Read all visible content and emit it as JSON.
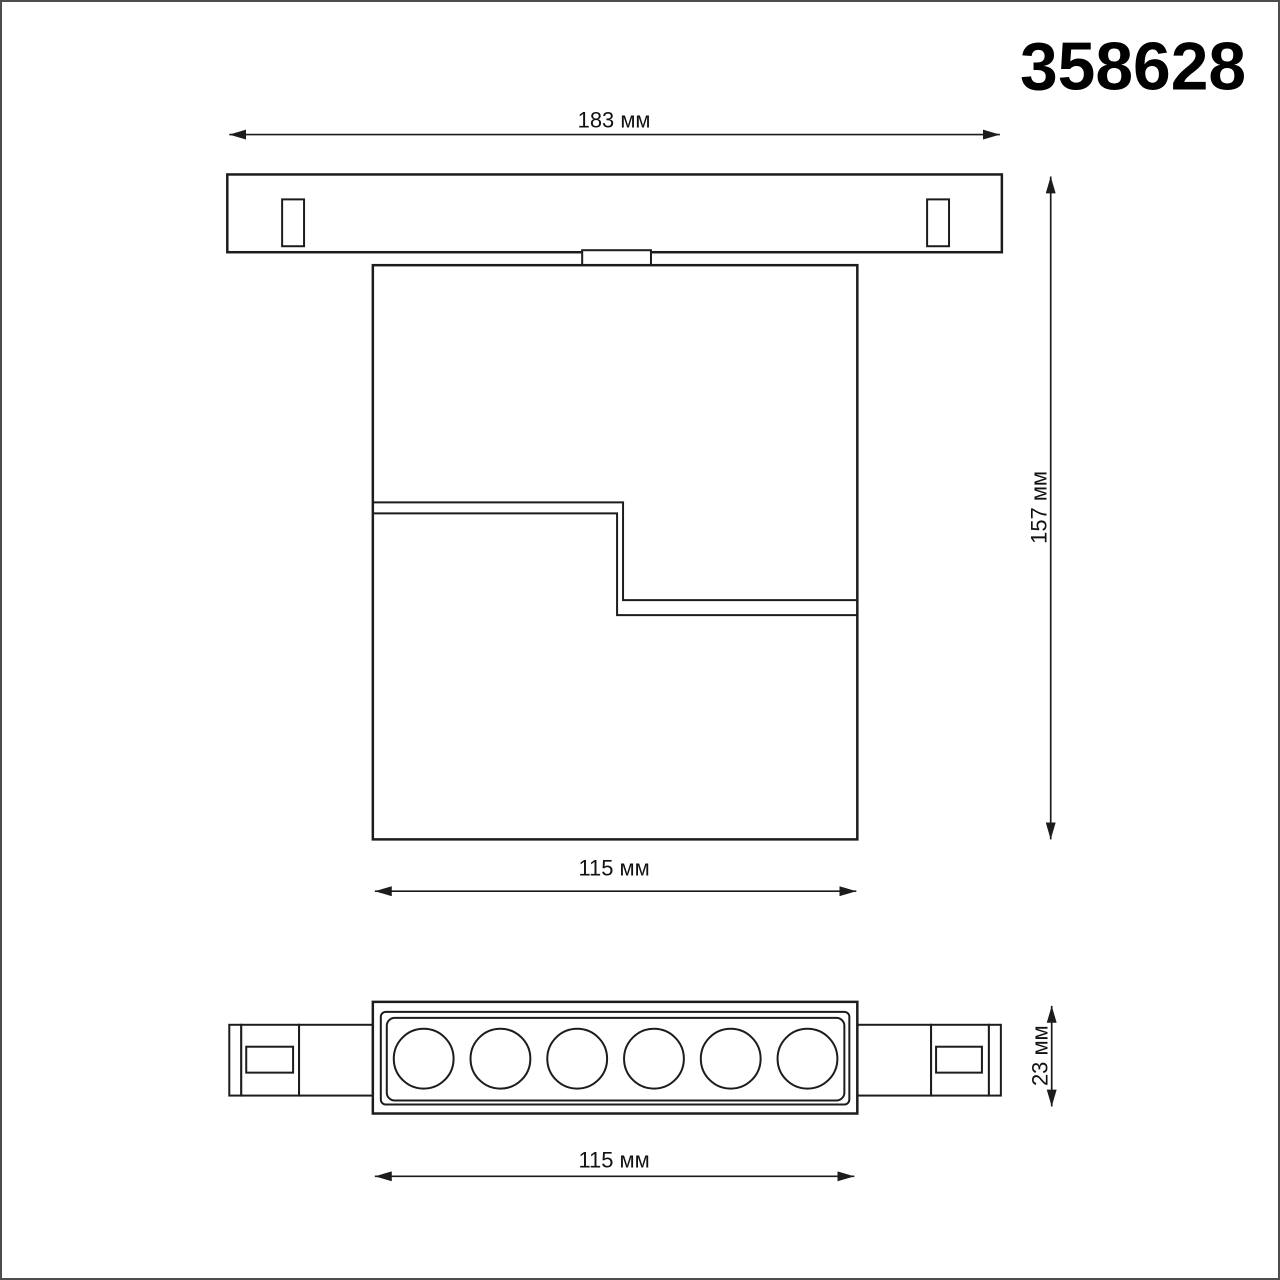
{
  "article_number": "358628",
  "dimensions": {
    "track_length": "183 мм",
    "assembly_height": "157 мм",
    "body_width": "115 мм",
    "fixture_length": "115 мм",
    "fixture_height": "23 мм"
  },
  "bottom_view": {
    "led_count": 6
  },
  "colors": {
    "line": "#1c1c1c",
    "background": "#ffffff",
    "page_border": "#4d4d4d"
  }
}
